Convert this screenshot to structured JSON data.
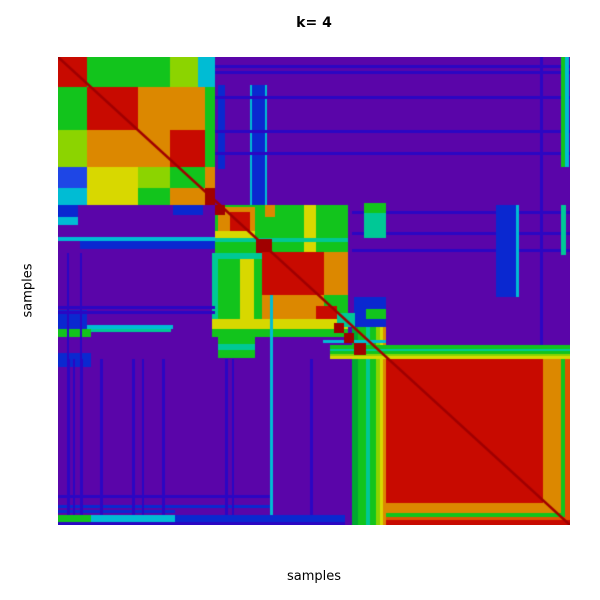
{
  "title": {
    "text": "k= 4"
  },
  "axes": {
    "x_label": "samples",
    "y_label": "samples"
  },
  "palette": {
    "p": "#5A05A9",
    "n": "#2B06C3",
    "B": "#0A28D0",
    "b": "#1E46E6",
    "c": "#00BCD4",
    "t": "#00C896",
    "g": "#12C41C",
    "G": "#00A830",
    "l": "#8CD400",
    "y": "#D8D800",
    "o": "#DC8800",
    "O": "#E05500",
    "r": "#C80A00",
    "R": "#A00000"
  },
  "heatmap": {
    "left": 58,
    "top": 57,
    "width": 512,
    "height": 468,
    "background": "p",
    "diagonal": {
      "color": "R",
      "line_width": 2.5
    },
    "regions": [
      [
        0,
        0,
        29,
        30,
        "r"
      ],
      [
        29,
        0,
        51,
        30,
        "g"
      ],
      [
        80,
        0,
        32,
        30,
        "g"
      ],
      [
        112,
        0,
        28,
        30,
        "l"
      ],
      [
        140,
        0,
        17,
        30,
        "c"
      ],
      [
        0,
        30,
        29,
        43,
        "g"
      ],
      [
        29,
        30,
        51,
        43,
        "r"
      ],
      [
        80,
        30,
        32,
        43,
        "o"
      ],
      [
        112,
        30,
        35,
        43,
        "o"
      ],
      [
        147,
        30,
        10,
        43,
        "g"
      ],
      [
        0,
        73,
        29,
        37,
        "l"
      ],
      [
        29,
        73,
        51,
        37,
        "o"
      ],
      [
        80,
        73,
        32,
        37,
        "o"
      ],
      [
        112,
        73,
        35,
        37,
        "r"
      ],
      [
        147,
        73,
        10,
        37,
        "g"
      ],
      [
        0,
        110,
        29,
        21,
        "b"
      ],
      [
        29,
        110,
        51,
        21,
        "y"
      ],
      [
        80,
        110,
        32,
        21,
        "l"
      ],
      [
        112,
        110,
        35,
        21,
        "g"
      ],
      [
        147,
        110,
        10,
        21,
        "o"
      ],
      [
        0,
        131,
        29,
        17,
        "c"
      ],
      [
        29,
        131,
        51,
        17,
        "y"
      ],
      [
        80,
        131,
        32,
        17,
        "g"
      ],
      [
        112,
        131,
        35,
        17,
        "o"
      ],
      [
        147,
        131,
        10,
        17,
        "R"
      ],
      [
        160,
        28,
        7,
        84,
        "B"
      ],
      [
        192,
        28,
        2,
        122,
        "c"
      ],
      [
        194,
        28,
        13,
        122,
        "B"
      ],
      [
        207,
        28,
        2,
        122,
        "c"
      ],
      [
        0,
        180,
        160,
        4,
        "c"
      ],
      [
        22,
        184,
        138,
        8,
        "B"
      ],
      [
        115,
        148,
        30,
        10,
        "B"
      ],
      [
        0,
        148,
        20,
        12,
        "B"
      ],
      [
        0,
        160,
        20,
        8,
        "c"
      ],
      [
        157,
        8,
        355,
        3,
        "n"
      ],
      [
        157,
        14,
        355,
        3,
        "n"
      ],
      [
        157,
        39,
        355,
        3,
        "n"
      ],
      [
        157,
        73,
        355,
        3,
        "n"
      ],
      [
        157,
        95,
        355,
        3,
        "n"
      ],
      [
        294,
        154,
        218,
        3,
        "n"
      ],
      [
        294,
        175,
        218,
        3,
        "n"
      ],
      [
        294,
        192,
        218,
        3,
        "n"
      ],
      [
        482,
        0,
        3,
        302,
        "n"
      ],
      [
        438,
        148,
        20,
        92,
        "B"
      ],
      [
        458,
        148,
        3,
        92,
        "c"
      ],
      [
        503,
        0,
        4,
        110,
        "g"
      ],
      [
        507,
        0,
        4,
        110,
        "c"
      ],
      [
        503,
        148,
        5,
        50,
        "t"
      ],
      [
        217,
        148,
        73,
        48,
        "g"
      ],
      [
        246,
        148,
        12,
        48,
        "y"
      ],
      [
        157,
        148,
        60,
        48,
        "g"
      ],
      [
        160,
        150,
        37,
        31,
        "o"
      ],
      [
        172,
        155,
        20,
        19,
        "r"
      ],
      [
        157,
        148,
        10,
        10,
        "R"
      ],
      [
        157,
        174,
        40,
        7,
        "y"
      ],
      [
        207,
        148,
        10,
        12,
        "o"
      ],
      [
        157,
        181,
        133,
        4,
        "t"
      ],
      [
        198,
        182,
        16,
        14,
        "R"
      ],
      [
        154,
        196,
        136,
        6,
        "t"
      ],
      [
        154,
        202,
        136,
        78,
        "g"
      ],
      [
        182,
        202,
        14,
        78,
        "y"
      ],
      [
        154,
        196,
        6,
        84,
        "t"
      ],
      [
        204,
        195,
        62,
        43,
        "r"
      ],
      [
        266,
        195,
        24,
        43,
        "o"
      ],
      [
        204,
        238,
        62,
        24,
        "o"
      ],
      [
        258,
        249,
        21,
        21,
        "r"
      ],
      [
        154,
        262,
        136,
        10,
        "y"
      ],
      [
        154,
        272,
        136,
        8,
        "g"
      ],
      [
        294,
        263,
        6,
        205,
        "G"
      ],
      [
        300,
        263,
        8,
        205,
        "g"
      ],
      [
        308,
        263,
        4,
        205,
        "t"
      ],
      [
        312,
        263,
        6,
        205,
        "g"
      ],
      [
        318,
        263,
        4,
        205,
        "l"
      ],
      [
        322,
        263,
        3,
        205,
        "y"
      ],
      [
        325,
        263,
        3,
        205,
        "o"
      ],
      [
        272,
        288,
        240,
        4,
        "g"
      ],
      [
        272,
        292,
        240,
        2,
        "t"
      ],
      [
        272,
        294,
        240,
        3,
        "g"
      ],
      [
        272,
        297,
        240,
        2,
        "l"
      ],
      [
        272,
        299,
        240,
        3,
        "y"
      ],
      [
        0,
        268,
        115,
        4,
        "c"
      ],
      [
        0,
        272,
        33,
        8,
        "g"
      ],
      [
        33,
        272,
        80,
        3,
        "t"
      ],
      [
        296,
        240,
        32,
        30,
        "B"
      ],
      [
        279,
        256,
        18,
        14,
        "t"
      ],
      [
        265,
        283,
        63,
        3,
        "c"
      ],
      [
        276,
        266,
        10,
        10,
        "R"
      ],
      [
        286,
        276,
        10,
        10,
        "R"
      ],
      [
        296,
        286,
        12,
        12,
        "R"
      ],
      [
        308,
        252,
        20,
        10,
        "g"
      ],
      [
        306,
        146,
        22,
        35,
        "t"
      ],
      [
        306,
        146,
        22,
        10,
        "g"
      ],
      [
        160,
        280,
        37,
        21,
        "g"
      ],
      [
        160,
        287,
        37,
        6,
        "t"
      ],
      [
        0,
        253,
        29,
        19,
        "B"
      ],
      [
        0,
        296,
        33,
        14,
        "B"
      ],
      [
        0,
        249,
        157,
        3,
        "n"
      ],
      [
        0,
        254,
        157,
        3,
        "n"
      ],
      [
        0,
        438,
        212,
        3,
        "n"
      ],
      [
        0,
        448,
        212,
        3,
        "B"
      ],
      [
        0,
        453,
        117,
        3,
        "B"
      ],
      [
        9,
        302,
        3,
        166,
        "n"
      ],
      [
        15,
        302,
        2,
        166,
        "n"
      ],
      [
        22,
        302,
        3,
        166,
        "n"
      ],
      [
        42,
        302,
        3,
        166,
        "n"
      ],
      [
        74,
        302,
        3,
        166,
        "n"
      ],
      [
        84,
        302,
        2,
        166,
        "n"
      ],
      [
        104,
        302,
        3,
        166,
        "n"
      ],
      [
        167,
        302,
        3,
        166,
        "n"
      ],
      [
        174,
        302,
        2,
        166,
        "n"
      ],
      [
        252,
        302,
        3,
        166,
        "n"
      ],
      [
        9,
        196,
        2,
        106,
        "n"
      ],
      [
        22,
        196,
        2,
        106,
        "n"
      ],
      [
        212,
        238,
        3,
        230,
        "c"
      ],
      [
        328,
        302,
        184,
        166,
        "r"
      ],
      [
        485,
        302,
        18,
        166,
        "o"
      ],
      [
        328,
        446,
        184,
        10,
        "o"
      ],
      [
        328,
        456,
        184,
        4,
        "g"
      ],
      [
        503,
        302,
        4,
        166,
        "g"
      ],
      [
        507,
        302,
        5,
        166,
        "O"
      ],
      [
        328,
        460,
        184,
        3,
        "O"
      ],
      [
        328,
        463,
        184,
        5,
        "r"
      ],
      [
        0,
        458,
        33,
        7,
        "g"
      ],
      [
        33,
        458,
        84,
        7,
        "c"
      ],
      [
        117,
        458,
        170,
        7,
        "B"
      ],
      [
        0,
        465,
        287,
        3,
        "n"
      ]
    ]
  },
  "chart_data": {
    "type": "heatmap",
    "title": "k= 4",
    "xlabel": "samples",
    "ylabel": "samples",
    "k": 4,
    "description": "Consensus clustering matrix (samples x samples) for k=4. Purple = low consensus background; warm colors = high consensus blocks along the diagonal.",
    "colorscale_low_to_high": [
      "#5A05A9",
      "#2B06C3",
      "#1E46E6",
      "#00BCD4",
      "#00C896",
      "#12C41C",
      "#8CD400",
      "#D8D800",
      "#DC8800",
      "#E05500",
      "#C80A00"
    ],
    "clusters": [
      {
        "id": 1,
        "extent_fraction": [
          0.0,
          0.31
        ],
        "consensus": "mixed red/green/orange sub-blocks"
      },
      {
        "id": 2,
        "extent_fraction": [
          0.31,
          0.42
        ],
        "consensus": "orange-red core with green/yellow halo"
      },
      {
        "id": 3,
        "extent_fraction": [
          0.4,
          0.56
        ],
        "consensus": "red core surrounded by orange and yellow-green bands"
      },
      {
        "id": 4,
        "extent_fraction": [
          0.64,
          1.0
        ],
        "consensus": "large solid red block with orange/green edge bands"
      }
    ],
    "grid": false,
    "legend": "none",
    "cell_data_encoding": "block rectangles listed in heatmap.regions as [x,y,w,h,palette_key] in plot pixels (512x468 area)"
  }
}
